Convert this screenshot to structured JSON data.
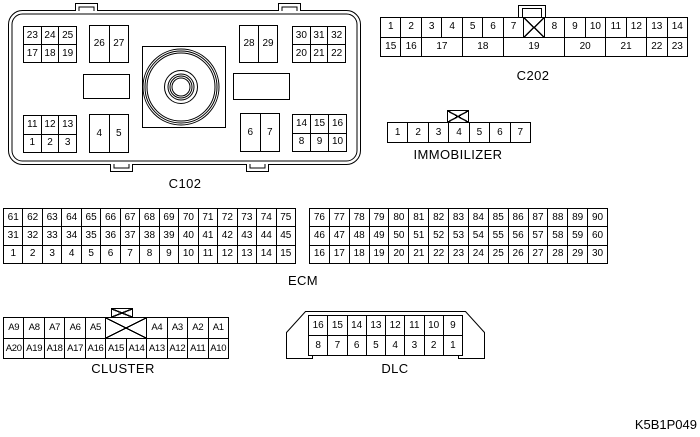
{
  "page": {
    "code": "K5B1P049",
    "background": "#ffffff",
    "line_color": "#000000"
  },
  "connectors": {
    "c102": {
      "label": "C102",
      "grids": {
        "top_left": [
          [
            "23",
            "24",
            "25"
          ],
          [
            "17",
            "18",
            "19"
          ]
        ],
        "top_mid_left": [
          [
            "26",
            "27"
          ]
        ],
        "top_mid_right": [
          [
            "28",
            "29"
          ]
        ],
        "top_right": [
          [
            "30",
            "31",
            "32"
          ],
          [
            "20",
            "21",
            "22"
          ]
        ],
        "bottom_left": [
          [
            "11",
            "12",
            "13"
          ],
          [
            "1",
            "2",
            "3"
          ]
        ],
        "bottom_mid_left": [
          [
            "4",
            "5"
          ]
        ],
        "bottom_mid_right": [
          [
            "6",
            "7"
          ]
        ],
        "bottom_right": [
          [
            "14",
            "15",
            "16"
          ],
          [
            "8",
            "9",
            "10"
          ]
        ]
      }
    },
    "c202": {
      "label": "C202",
      "latch_icon": "plain-tab",
      "row1": [
        "1",
        "2",
        "3",
        "4",
        "5",
        "6",
        "7",
        {
          "x": true
        },
        "8",
        "9",
        "10",
        "11",
        "12",
        "13",
        "14"
      ],
      "row2": [
        "15",
        "16",
        {
          "label": "17",
          "span": 2
        },
        {
          "label": "18",
          "span": 2
        },
        {
          "label": "19",
          "span": 3
        },
        {
          "label": "20",
          "span": 2
        },
        {
          "label": "21",
          "span": 2
        },
        "22",
        "23"
      ]
    },
    "immobilizer": {
      "label": "IMMOBILIZER",
      "latch_icon": "x-box",
      "row": [
        "1",
        "2",
        "3",
        "4",
        "5",
        "6",
        "7"
      ]
    },
    "ecm": {
      "label": "ECM",
      "left_rows": [
        [
          "61",
          "62",
          "63",
          "64",
          "65",
          "66",
          "67",
          "68",
          "69",
          "70",
          "71",
          "72",
          "73",
          "74",
          "75"
        ],
        [
          "31",
          "32",
          "33",
          "34",
          "35",
          "36",
          "37",
          "38",
          "39",
          "40",
          "41",
          "42",
          "43",
          "44",
          "45"
        ],
        [
          "1",
          "2",
          "3",
          "4",
          "5",
          "6",
          "7",
          "8",
          "9",
          "10",
          "11",
          "12",
          "13",
          "14",
          "15"
        ]
      ],
      "right_rows": [
        [
          "76",
          "77",
          "78",
          "79",
          "80",
          "81",
          "82",
          "83",
          "84",
          "85",
          "86",
          "87",
          "88",
          "89",
          "90"
        ],
        [
          "46",
          "47",
          "48",
          "49",
          "50",
          "51",
          "52",
          "53",
          "54",
          "55",
          "56",
          "57",
          "58",
          "59",
          "60"
        ],
        [
          "16",
          "17",
          "18",
          "19",
          "20",
          "21",
          "22",
          "23",
          "24",
          "25",
          "26",
          "27",
          "28",
          "29",
          "30"
        ]
      ]
    },
    "cluster": {
      "label": "CLUSTER",
      "latch_icon": "x-box",
      "row1": [
        "A9",
        "A8",
        "A7",
        "A6",
        "A5",
        {
          "x": true,
          "span": 2
        },
        "A4",
        "A3",
        "A2",
        "A1"
      ],
      "row2": [
        "A20",
        "A19",
        "A18",
        "A17",
        "A16",
        "A15",
        "A14",
        "A13",
        "A12",
        "A11",
        "A10"
      ]
    },
    "dlc": {
      "label": "DLC",
      "row1": [
        "16",
        "15",
        "14",
        "13",
        "12",
        "11",
        "10",
        "9"
      ],
      "row2": [
        "8",
        "7",
        "6",
        "5",
        "4",
        "3",
        "2",
        "1"
      ]
    }
  }
}
